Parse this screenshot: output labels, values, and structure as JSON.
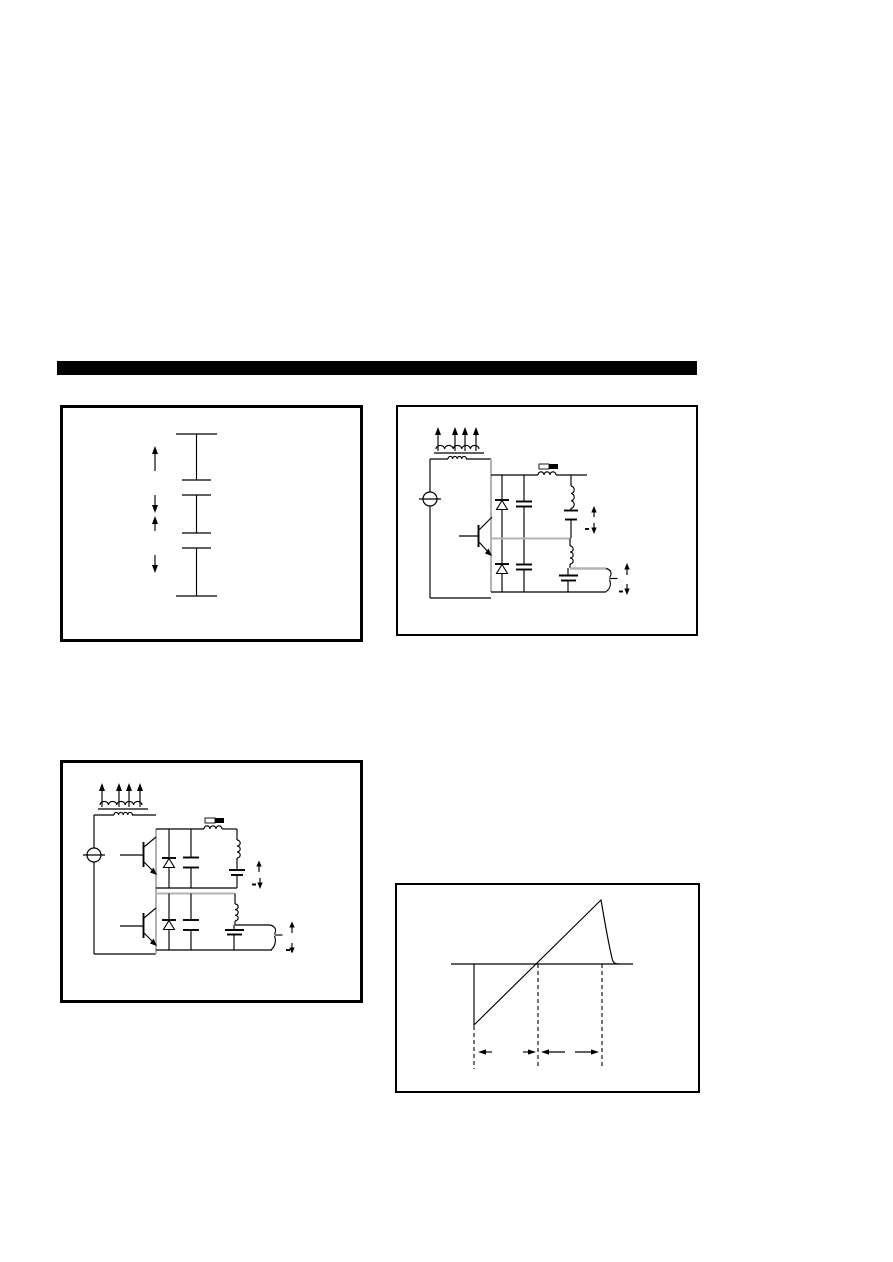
{
  "colors": {
    "page_bg": "#ffffff",
    "ink": "#000000",
    "gray_line": "#b3b3b3",
    "header_bar": "#000000"
  },
  "header": {
    "type": "solid-black-section-bar",
    "visible_text": ""
  },
  "figures": [
    {
      "name": "capacitor-stack-diagram",
      "position": "top-left",
      "elements": [
        "three stacked plate segments separated by two gaps",
        "upward arrow",
        "converging arrow pair",
        "downward arrow"
      ]
    },
    {
      "name": "single-transistor-output-circuit",
      "position": "top-right",
      "elements": [
        "voltage source circle",
        "transformer winding with four upward arrows",
        "one NPN transistor",
        "two damper diodes",
        "two retrace capacitors",
        "horizontal linearity coil with black-and-white label chip",
        "two series LC output branches",
        "polarity arrow pairs with minus marks",
        "curly output connector"
      ]
    },
    {
      "name": "dual-transistor-output-circuit",
      "position": "middle-left",
      "elements": [
        "voltage source circle",
        "transformer winding with four upward arrows",
        "two stacked NPN transistors",
        "two diodes",
        "two capacitors",
        "horizontal linearity coil with black-and-white label chip",
        "two series LC output branches",
        "polarity arrow pairs with minus marks",
        "curly output connector"
      ]
    },
    {
      "name": "sawtooth-waveform-diagram",
      "position": "bottom-right",
      "waveform": {
        "type": "sawtooth",
        "description": "linear ramp rising from below the baseline, crossing it mid-way, peaking above it, then fast curved retrace back to the baseline",
        "vertical_dashed_markers": 3,
        "marked_intervals": 2,
        "interval_marker_style": "outward-pointing dimension arrows under the baseline"
      }
    }
  ]
}
